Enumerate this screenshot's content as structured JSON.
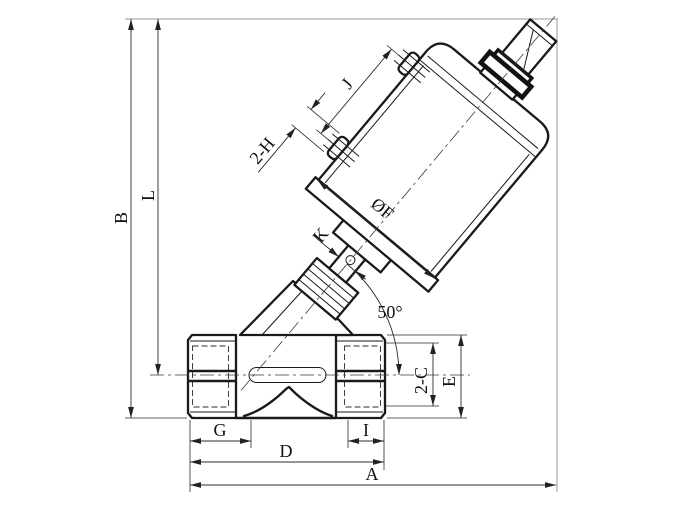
{
  "dim_labels": {
    "b": "B",
    "l": "L",
    "j": "J",
    "h2": "2-H",
    "k": "K",
    "f": "ØF",
    "angle": "50°",
    "c2": "2-C",
    "e": "E",
    "g": "G",
    "i": "I",
    "d": "D",
    "a": "A"
  },
  "colors": {
    "part_outline": "#1a1a1a",
    "dimension_lines": "#2b2b2b",
    "frame_extension_lines": "#9a9a9a",
    "background": "#ffffff"
  }
}
